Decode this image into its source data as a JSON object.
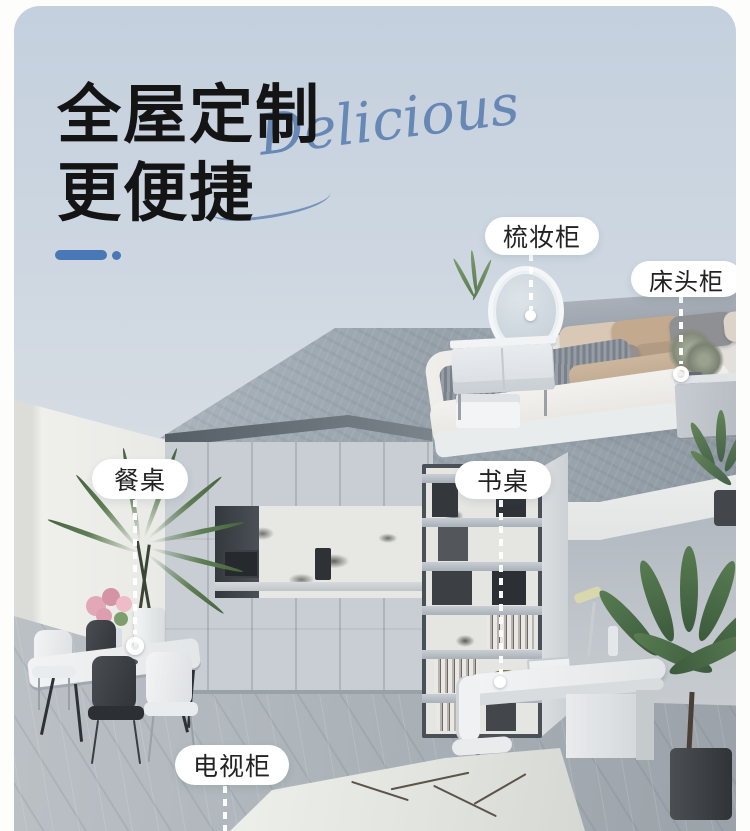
{
  "header": {
    "title_line1": "全屋定制",
    "title_line2": "更便捷",
    "script_word": "Delicious"
  },
  "callouts": [
    {
      "label": "梳妆柜"
    },
    {
      "label": "床头柜"
    },
    {
      "label": "餐桌"
    },
    {
      "label": "书桌"
    },
    {
      "label": "电视柜"
    }
  ],
  "colors": {
    "page_bg": "#ffffff",
    "card_bg_top": "#c4d0de",
    "card_bg_bottom": "#d9dee3",
    "headline_text": "#141414",
    "script_text": "#6787b4",
    "accent_blue": "#4878b6",
    "callout_bg": "#ffffff",
    "callout_text": "#222222"
  }
}
